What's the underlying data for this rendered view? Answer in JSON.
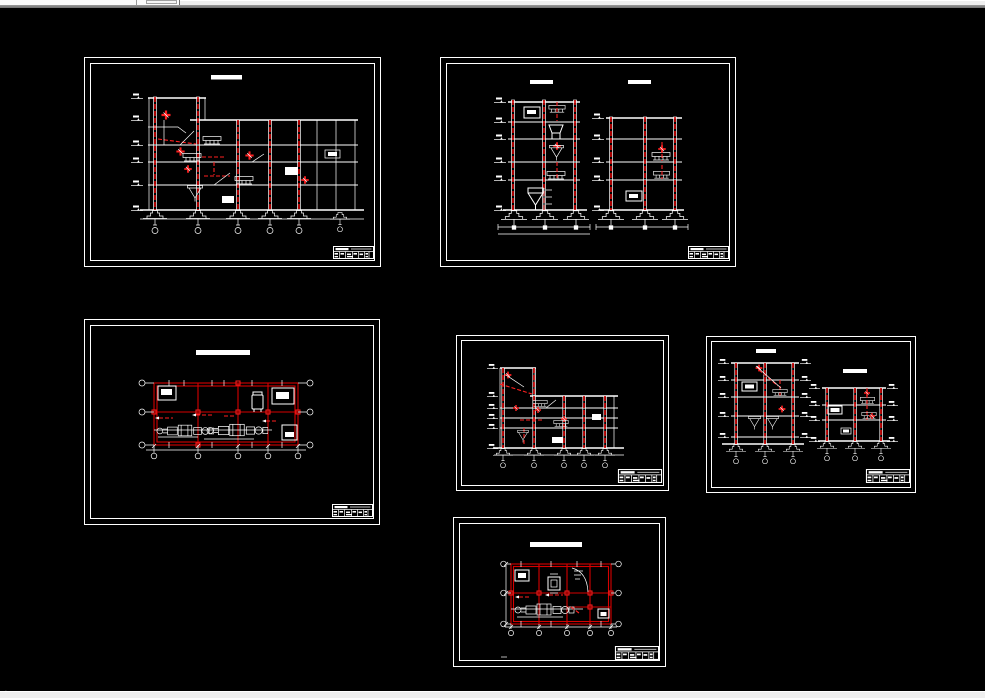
{
  "colors": {
    "canvas": "#000000",
    "line": "#ffffff",
    "red": "#d60000",
    "red2": "#ff2020",
    "chrome_face": "#efefef",
    "chrome_light": "#fbfbfb",
    "chrome_band": "#9b9b9b",
    "chrome_edge": "#6e6e6e"
  },
  "window": {
    "top_toolbar_fragment": {
      "kind": "clipped-toolbar-edge",
      "mini_box_count": 1
    },
    "bottom_statusbar_fragment": {
      "kind": "clipped-statusbar-edge"
    }
  },
  "viewport": {
    "mode": "model-space",
    "sheet_count": 6,
    "sheets": [
      {
        "id": "sheet-1",
        "drawing_type": "building-section-elevation",
        "position": "top-left",
        "title_blobs": 1,
        "footings": 6
      },
      {
        "id": "sheet-2",
        "drawing_type": "two-tower-sections",
        "position": "top-right",
        "title_blobs": 2,
        "footings": 6
      },
      {
        "id": "sheet-3",
        "drawing_type": "floor-plan",
        "position": "middle-left",
        "title_blobs": 1,
        "grid_bays": 4
      },
      {
        "id": "sheet-4",
        "drawing_type": "building-section-elevation",
        "position": "middle-center",
        "title_blobs": 0,
        "footings": 5
      },
      {
        "id": "sheet-5",
        "drawing_type": "two-tower-sections",
        "position": "middle-right",
        "title_blobs": 2,
        "footings": 6
      },
      {
        "id": "sheet-6",
        "drawing_type": "floor-plan",
        "position": "bottom-center",
        "title_blobs": 1,
        "grid_bays": 4
      }
    ]
  }
}
